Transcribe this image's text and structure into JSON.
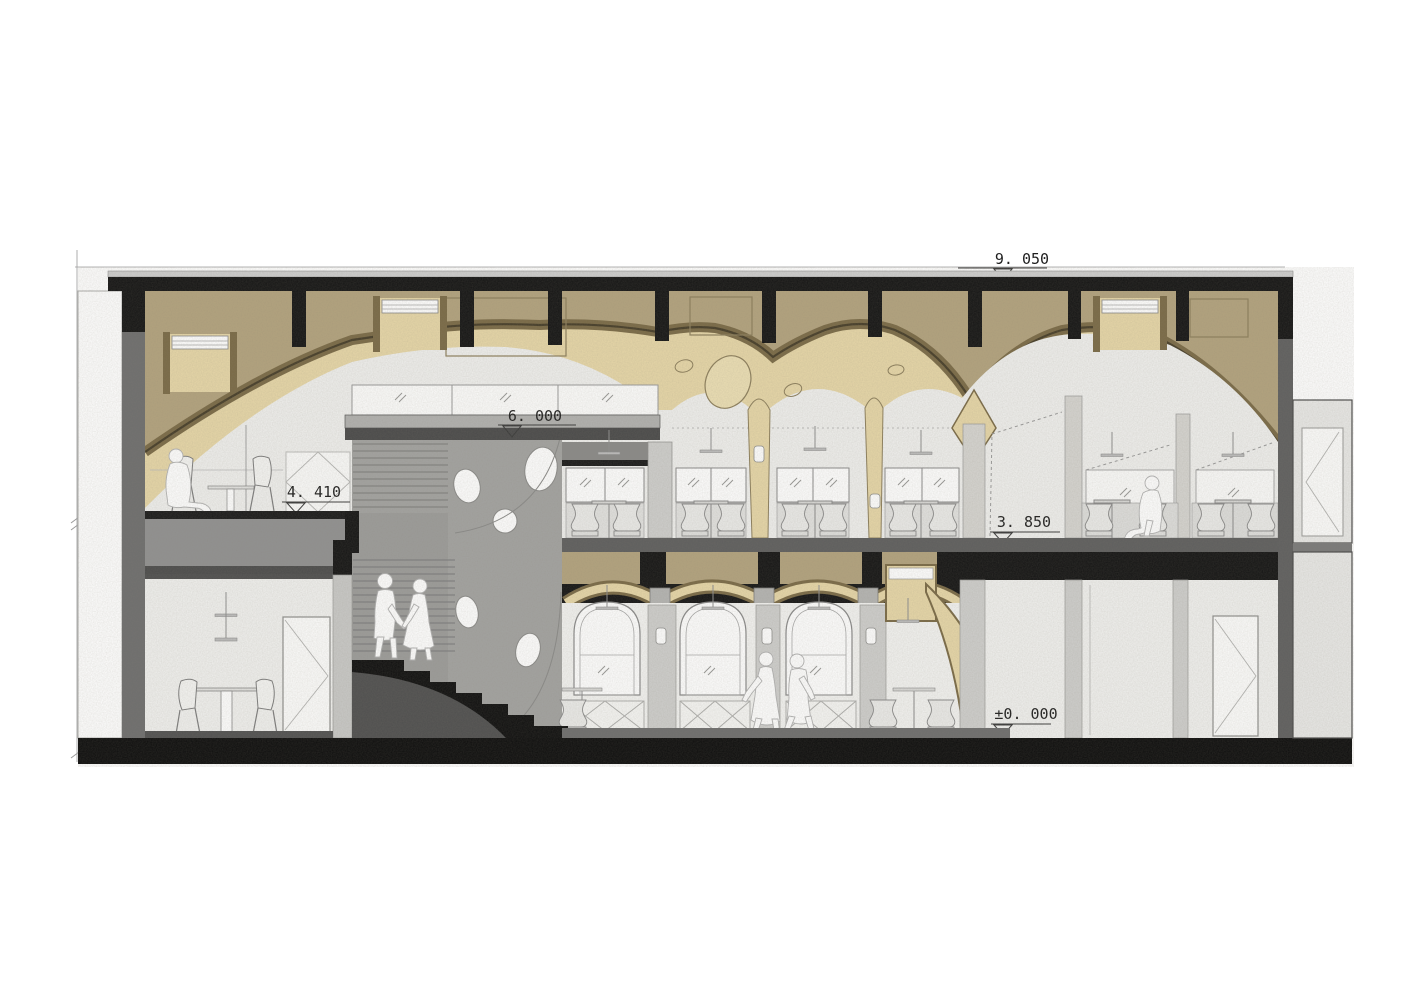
{
  "drawing": {
    "type": "architectural-section",
    "elevation_markers": {
      "roof": "9. 050",
      "mezzanine": "6. 000",
      "upper_left_floor": "4. 410",
      "restaurant_floor": "3. 850",
      "ground_floor": "±0. 000"
    },
    "palette": {
      "vault_dark_tan": "#b3a37e",
      "vault_cream": "#e7d7a8",
      "vault_brown_band": "#7a6a46",
      "vault_brown_dark": "#463d28",
      "wall_gray": "#a3a3a1",
      "pier_light_gray": "#d6d5d1",
      "room_light": "#f0f0ee",
      "slab_dark": "#5e5e5e",
      "structure_black": "#141414",
      "annex_light": "#e9e9e7"
    }
  }
}
